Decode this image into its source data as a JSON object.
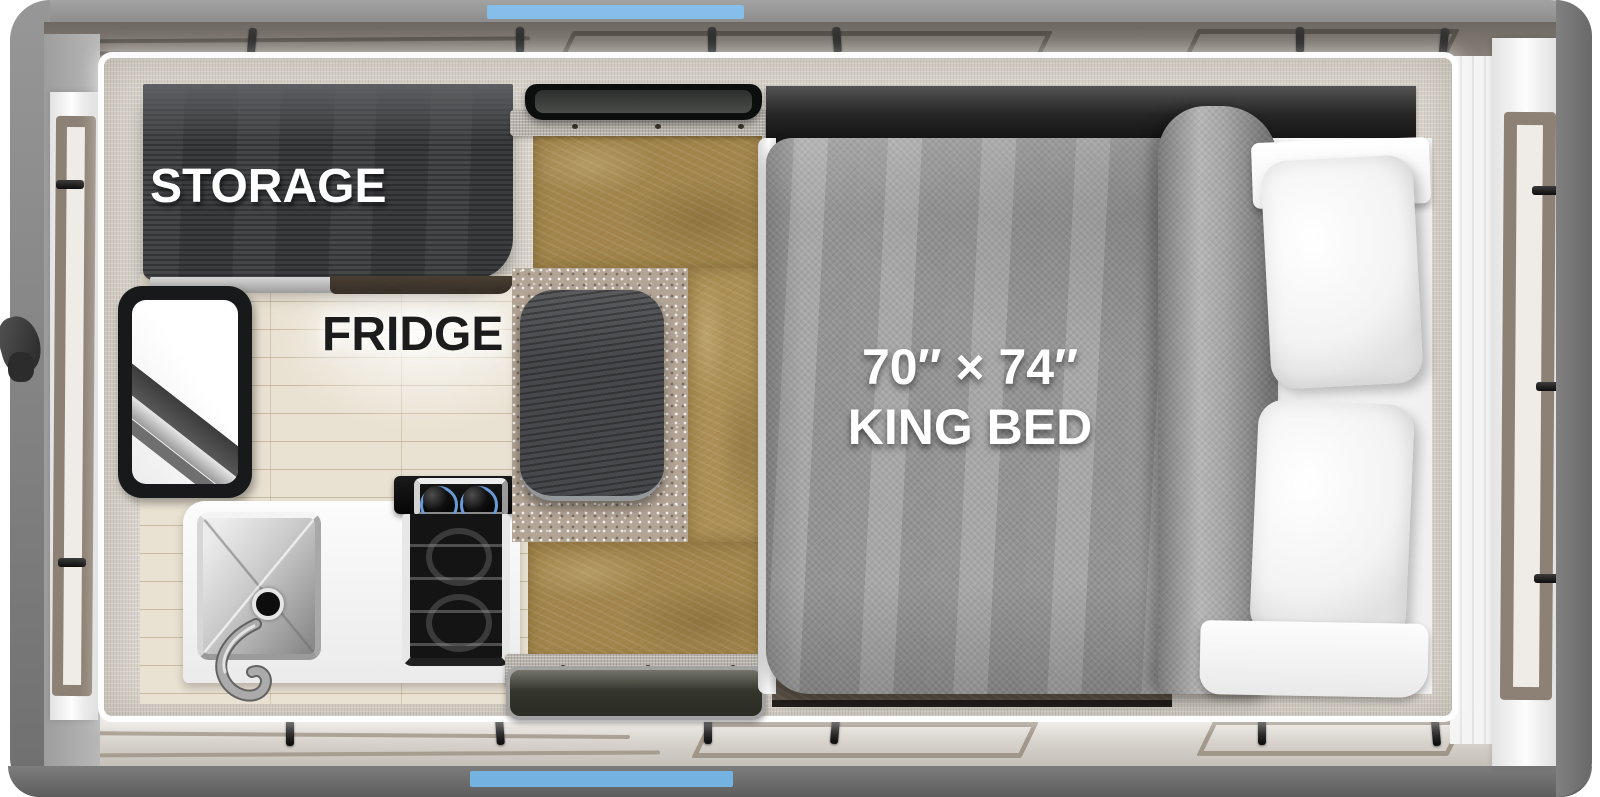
{
  "floorplan": {
    "title": "Truck camper floor plan (top view)",
    "labels": {
      "storage": "STORAGE",
      "fridge": "FRIDGE",
      "bed_size": "70″ × 74″",
      "bed_name": "KING BED"
    },
    "features": [
      "storage-cabinet",
      "entry-window",
      "kitchen-sink",
      "two-burner-stove",
      "oven",
      "dinette-table",
      "dinette-bench",
      "dinette-carpet",
      "roof-vent",
      "entry-mat",
      "king-bed",
      "blanket",
      "pillow",
      "pillow",
      "camper-shell",
      "fold-down-panels"
    ],
    "colors": {
      "accent_blue_top": "#85bfe9",
      "accent_blue_bottom": "#74b2e2",
      "body_gray": "#8f8f8f",
      "cabinet_charcoal": "#3a3c3e",
      "leather_brown": "#a1854b",
      "carpet_taupe": "#b3a596",
      "blanket_gray": "#9c9c9c",
      "wood_floor": "#e9e1d1",
      "trim_taupe": "#8d8175",
      "label_white": "#ffffff",
      "label_dark": "#1c1c1c"
    }
  }
}
